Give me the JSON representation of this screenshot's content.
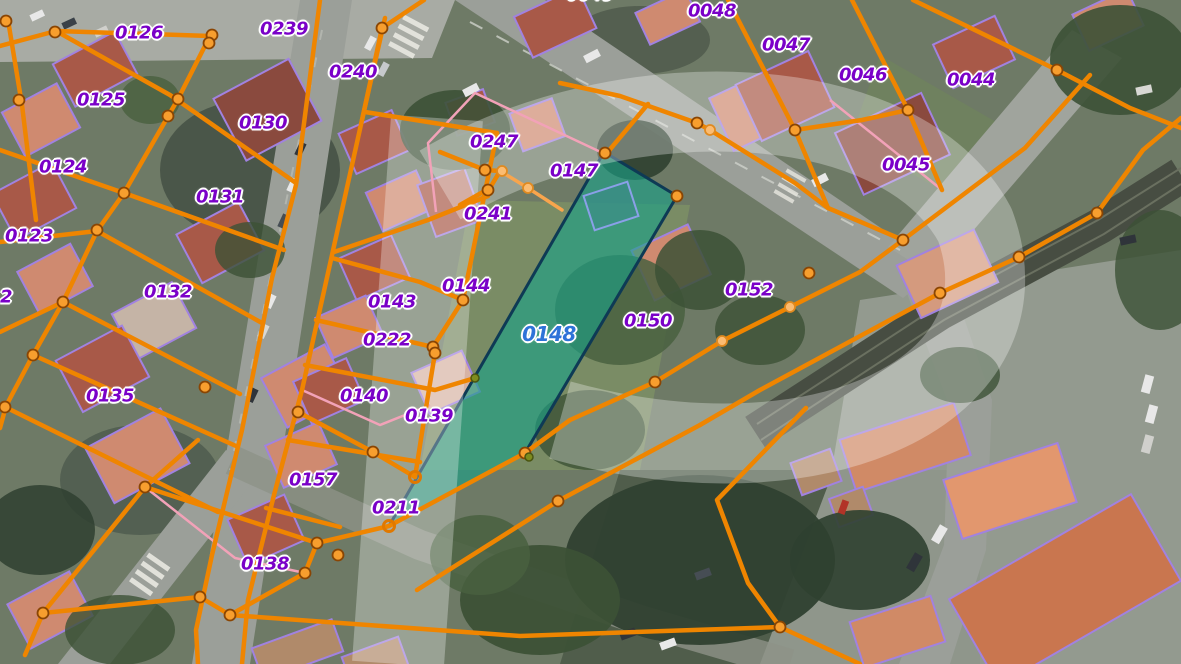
{
  "map": {
    "type": "cadastral-parcel-overlay-on-aerial-imagery",
    "highlight": {
      "parcel_id": "0148",
      "fill": "#18a188",
      "border": "#0e3a55",
      "label_color": "#2e73d8"
    },
    "colors": {
      "parcel_line": "#ef8500",
      "parcel_line_light": "#f8a54d",
      "vertex_fill": "#f79e2e",
      "vertex_fill_light": "#fbbc72",
      "building_outline": "#a182e0",
      "sub_parcel_line": "#f2a2b8",
      "label": "#7a00c8"
    },
    "watermark": {
      "letter": "P",
      "color": "rgba(255,255,255,0.30)"
    },
    "labels": [
      {
        "text": "0126",
        "x": 139,
        "y": 33
      },
      {
        "text": "0239",
        "x": 284,
        "y": 29
      },
      {
        "text": "0240",
        "x": 353,
        "y": 72
      },
      {
        "text": "0125",
        "x": 101,
        "y": 100
      },
      {
        "text": "0130",
        "x": 263,
        "y": 123
      },
      {
        "text": "0124",
        "x": 63,
        "y": 167
      },
      {
        "text": "0131",
        "x": 220,
        "y": 197
      },
      {
        "text": "0123",
        "x": 29,
        "y": 236
      },
      {
        "text": "0132",
        "x": 168,
        "y": 292
      },
      {
        "text": "2",
        "x": 6,
        "y": 297
      },
      {
        "text": "0135",
        "x": 110,
        "y": 396
      },
      {
        "text": "0247",
        "x": 494,
        "y": 142
      },
      {
        "text": "0241",
        "x": 488,
        "y": 214
      },
      {
        "text": "0143",
        "x": 392,
        "y": 302
      },
      {
        "text": "0144",
        "x": 466,
        "y": 286
      },
      {
        "text": "0222",
        "x": 387,
        "y": 340
      },
      {
        "text": "0140",
        "x": 364,
        "y": 396
      },
      {
        "text": "0139",
        "x": 429,
        "y": 416
      },
      {
        "text": "0157",
        "x": 313,
        "y": 480
      },
      {
        "text": "0211",
        "x": 396,
        "y": 508
      },
      {
        "text": "0138",
        "x": 265,
        "y": 564
      },
      {
        "text": "0147",
        "x": 574,
        "y": 171
      },
      {
        "text": "0148",
        "x": 549,
        "y": 334,
        "variant": "highlight"
      },
      {
        "text": "0150",
        "x": 648,
        "y": 321
      },
      {
        "text": "0152",
        "x": 749,
        "y": 290
      },
      {
        "text": "0048",
        "x": 712,
        "y": 11
      },
      {
        "text": "0047",
        "x": 786,
        "y": 45
      },
      {
        "text": "0046",
        "x": 863,
        "y": 75
      },
      {
        "text": "0044",
        "x": 971,
        "y": 80
      },
      {
        "text": "0045",
        "x": 906,
        "y": 165
      },
      {
        "text": "0049",
        "x": 590,
        "y": -6
      },
      {
        "text": "0043",
        "x": 1044,
        "y": -9
      }
    ]
  }
}
